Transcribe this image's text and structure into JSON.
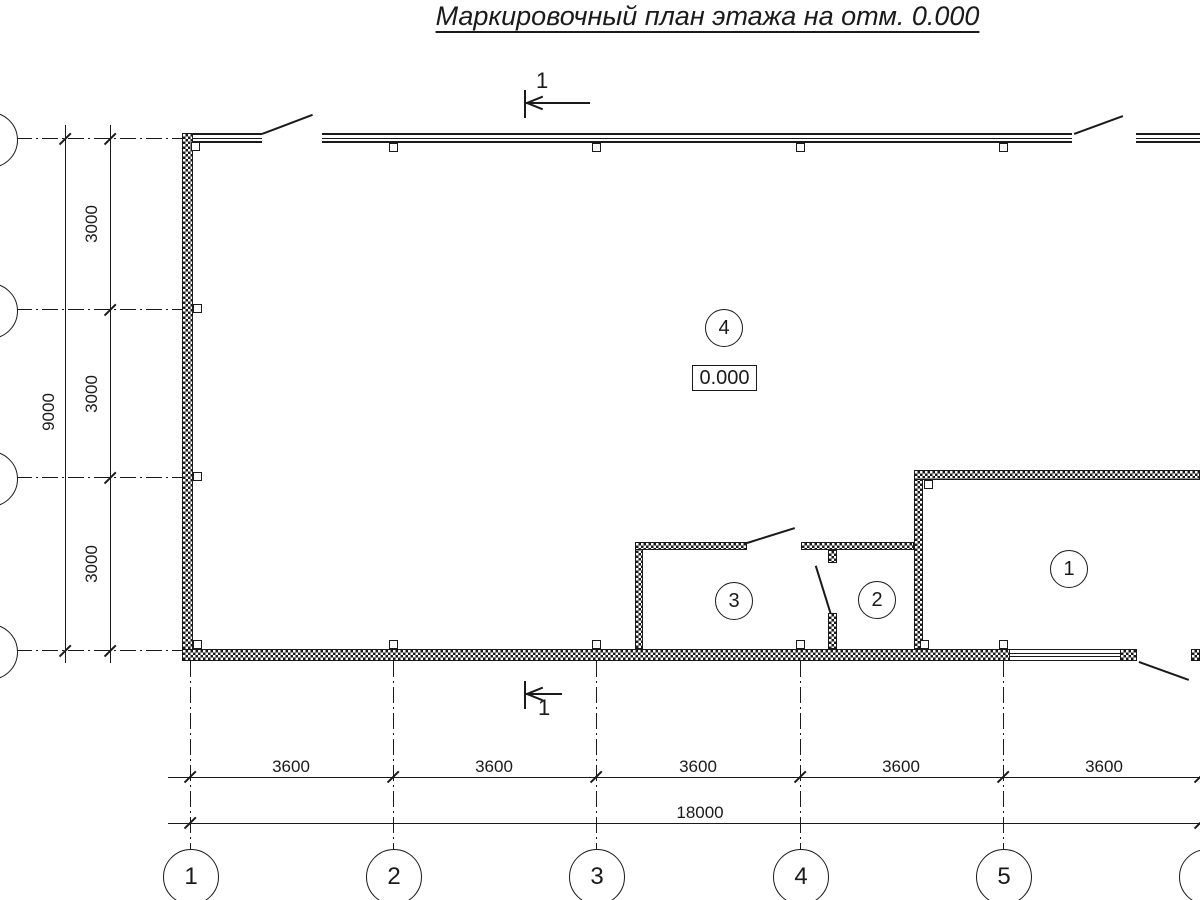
{
  "colors": {
    "ink": "#1a1a1a",
    "paper": "#ffffff"
  },
  "title": "Маркировочный план этажа на отм. 0.000",
  "section_label": "1",
  "elevation": "0.000",
  "rooms": [
    "1",
    "2",
    "3",
    "4"
  ],
  "axes": {
    "bottom": [
      "1",
      "2",
      "3",
      "4",
      "5",
      "6"
    ],
    "left": [
      "Г",
      "В",
      "Б",
      "А"
    ]
  },
  "dims": {
    "bays_h": [
      "3600",
      "3600",
      "3600",
      "3600",
      "3600"
    ],
    "total_h": "18000",
    "bays_v": [
      "3000",
      "3000",
      "3000"
    ],
    "total_v": "9000"
  }
}
